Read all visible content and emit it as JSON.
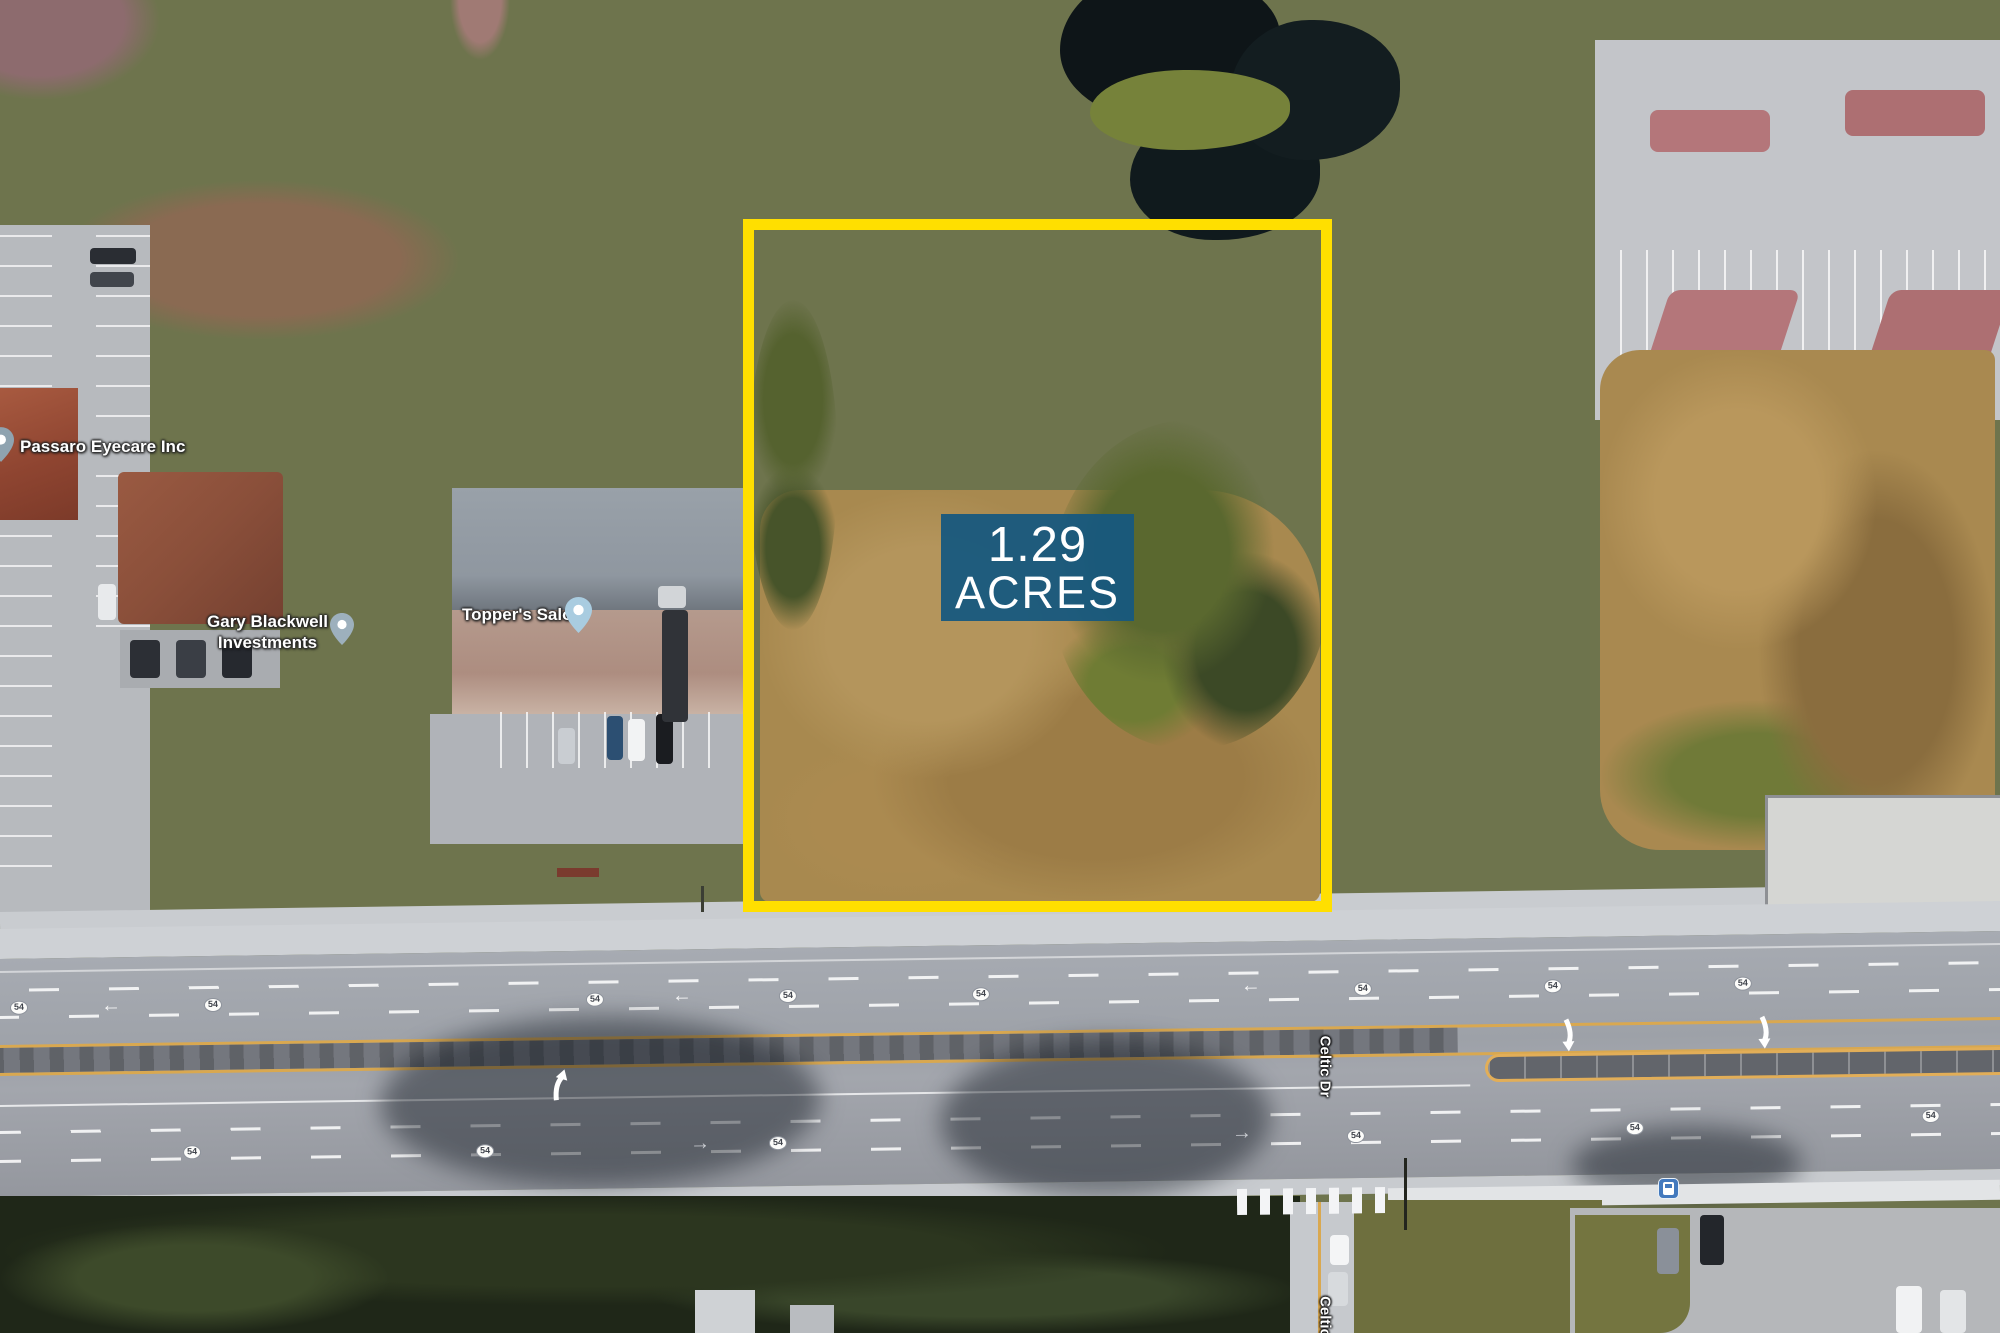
{
  "overlay": {
    "acreage_line1": "1.29",
    "acreage_line2": "ACRES",
    "badge_color": "#17587e",
    "parcel_outline_color": "#ffdf00"
  },
  "labels": {
    "passaro": "Passaro Eyecare Inc",
    "gary_line1": "Gary Blackwell",
    "gary_line2": "Investments",
    "toppers": "Topper's Salon",
    "celtic_dr": "Celtic Dr",
    "celtic_partial": "Celtic",
    "route_shield": "54"
  },
  "icons": {
    "poi_pin": "map-pin-icon",
    "bus_stop": "bus-stop-icon",
    "lane_arrow_left": "←",
    "lane_arrow_right": "→"
  }
}
